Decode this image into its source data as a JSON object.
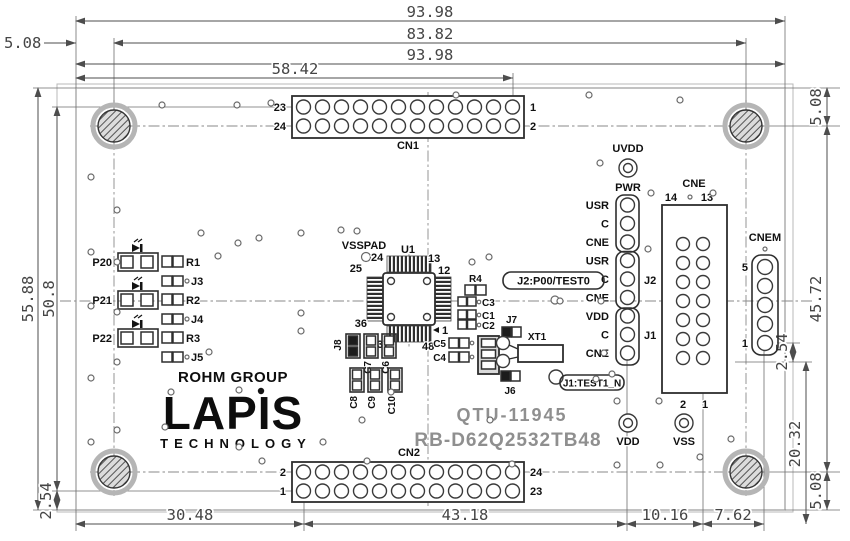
{
  "title": {
    "model": "QTU-11945",
    "board": "RB-D62Q2532TB48"
  },
  "logo": {
    "group": "ROHM GROUP",
    "brand": "LAPIS",
    "division": "TECHNOLOGY"
  },
  "dims": {
    "top_full_1": "93.98",
    "top_holes": "83.82",
    "top_left_offset": "5.08",
    "top_full_2": "93.98",
    "top_cn1": "58.42",
    "bottom": [
      "30.48",
      "43.18",
      "10.16",
      "7.62"
    ],
    "left_height": "55.88",
    "left_rows": "50.8",
    "left_pitch": "2.54",
    "right_top_offset": "5.08",
    "right_holes_span": "45.72",
    "right_pitch": "2.54",
    "right_cne_span": "20.32",
    "right_bottom_offset": "5.08"
  },
  "cn1": {
    "ref": "CN1",
    "left_top": "23",
    "left_bottom": "24",
    "right_top": "1",
    "right_bottom": "2"
  },
  "cn2": {
    "ref": "CN2",
    "left_top": "2",
    "left_bottom": "1",
    "right_top": "24",
    "right_bottom": "23"
  },
  "cne": {
    "ref": "CNE",
    "top_left_pin": "14",
    "top_right_pin": "13",
    "bottom_left_pin": "2",
    "bottom_right_pin": "1"
  },
  "cnem": {
    "ref": "CNEM",
    "top_pin": "5",
    "bottom_pin": "1"
  },
  "pwr": {
    "ref": "PWR",
    "testpoint": "UVDD",
    "pins": [
      "USR",
      "C",
      "CNE",
      "USR",
      "C",
      "CNE",
      "VDD",
      "C",
      "CNE"
    ],
    "j2": "J2",
    "j1": "J1"
  },
  "callouts": {
    "j2": "J2:P00/TEST0",
    "j1": "J1:TEST1_N"
  },
  "testpoints": {
    "vdd": "VDD",
    "vss": "VSS"
  },
  "u1": {
    "ref": "U1",
    "pad": "VSSPAD",
    "pin24": "24",
    "pin25": "25",
    "pin13": "13",
    "pin12": "12",
    "pin1": "1",
    "pin48": "48",
    "pin37": "37",
    "pin36": "36"
  },
  "leds": [
    {
      "name": "P20",
      "resistor": "R1"
    },
    {
      "name": "P21",
      "resistor": "R2"
    },
    {
      "name": "P22",
      "resistor": "R3"
    }
  ],
  "jumpers": [
    "J3",
    "J4",
    "J5"
  ],
  "parts": {
    "r4": "R4",
    "c3": "C3",
    "c1": "C1",
    "c2": "C2",
    "c5": "C5",
    "c4": "C4",
    "j7": "J7",
    "xt1": "XT1",
    "j6": "J6",
    "j8": "J8",
    "c7": "C7",
    "c6": "C6",
    "c8": "C8",
    "c9": "C9",
    "c10": "C10"
  }
}
